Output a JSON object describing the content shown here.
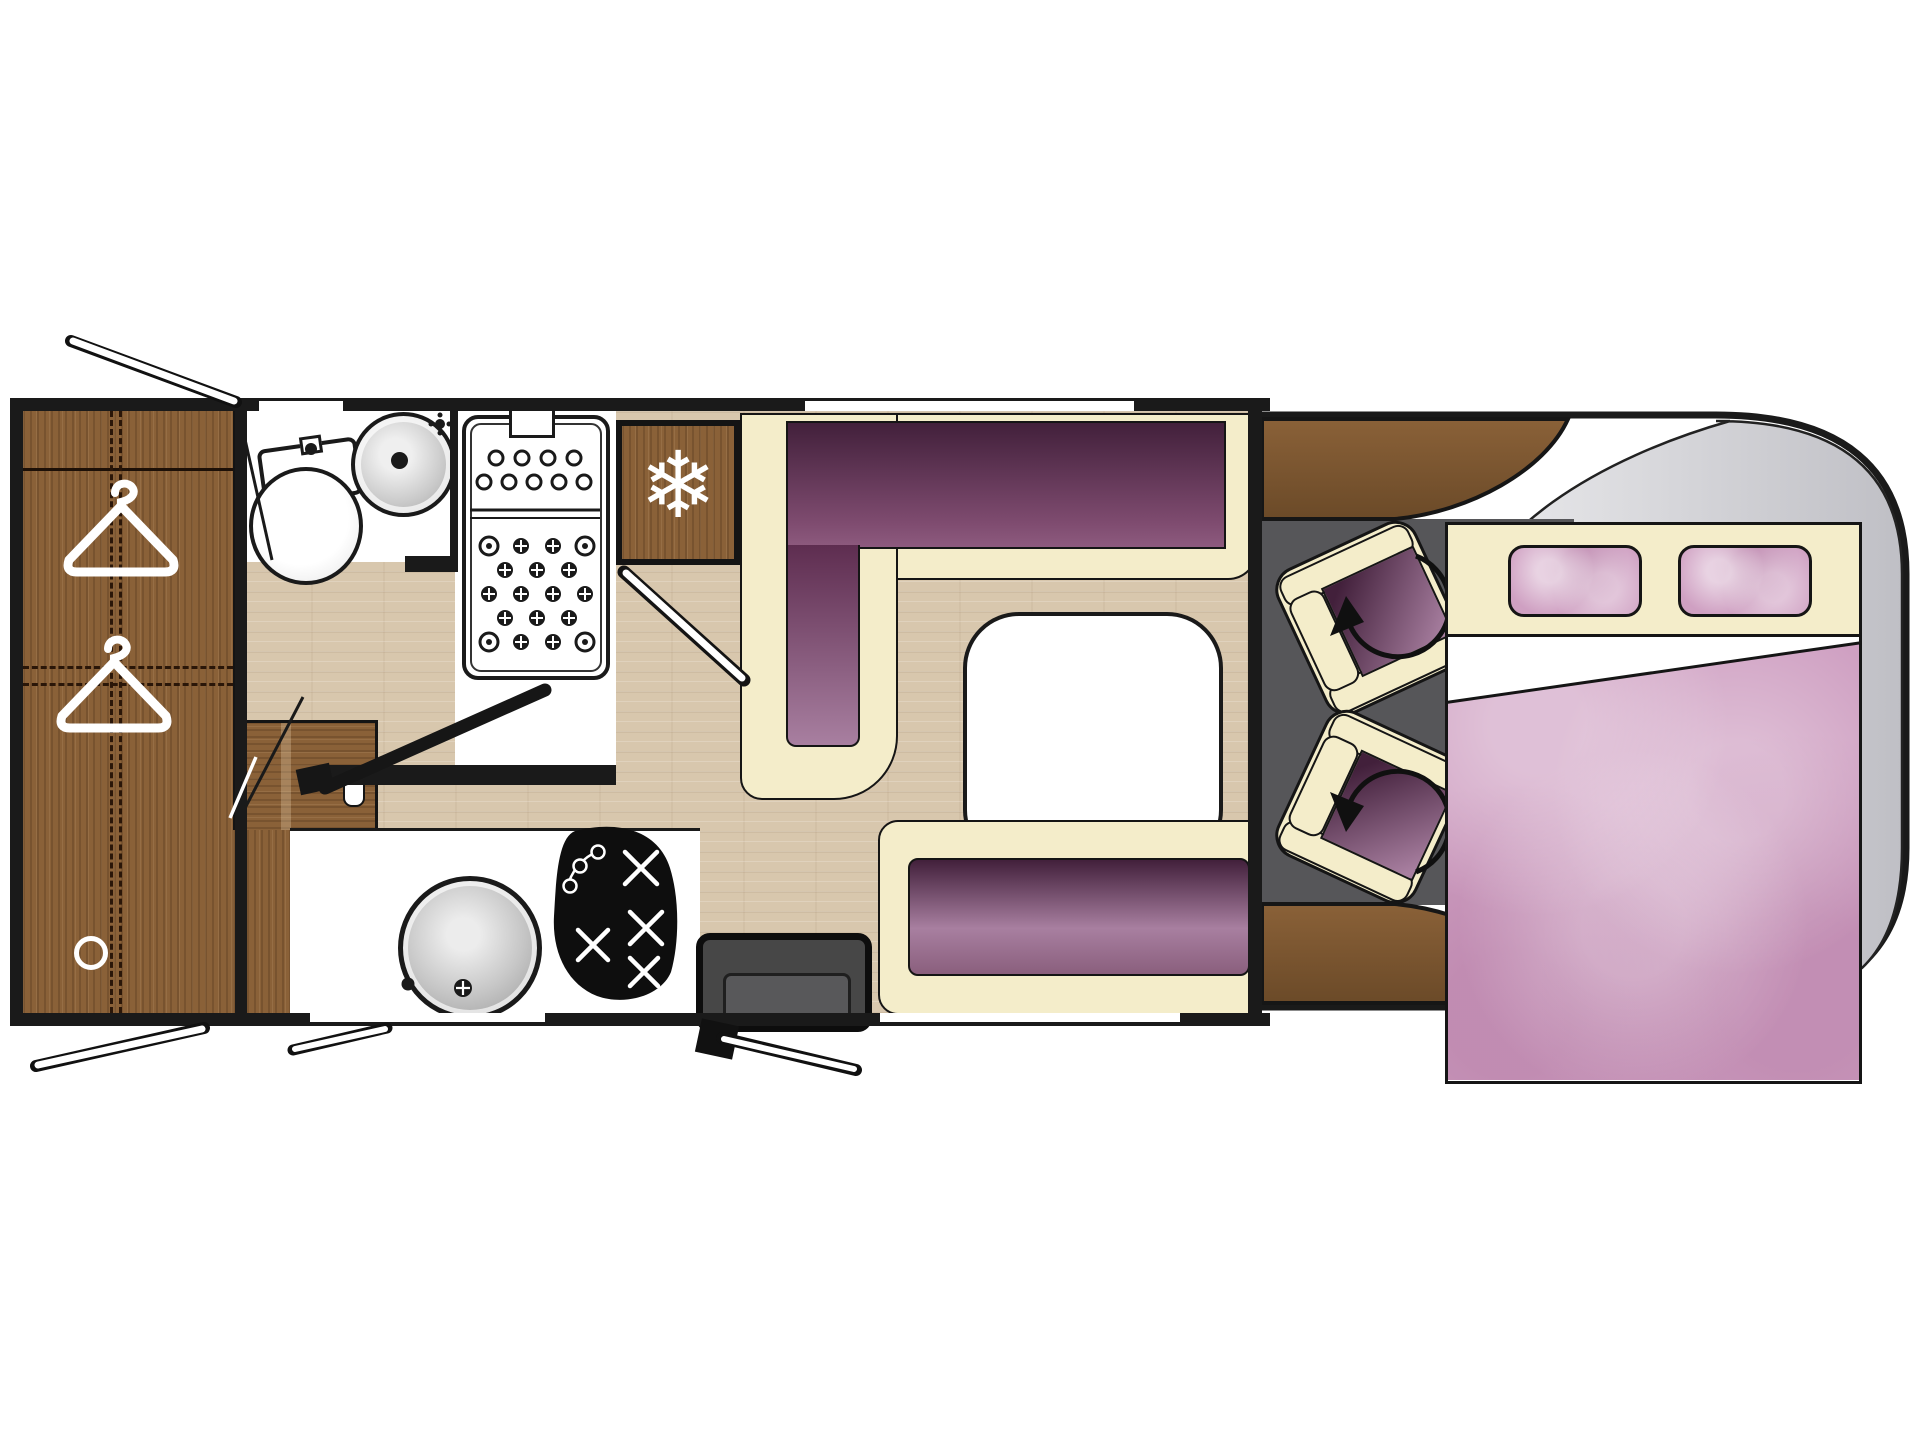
{
  "title": "motorhome-floorplan",
  "colors": {
    "wall": "#1a1a1a",
    "outline": "#151515",
    "white": "#ffffff",
    "floor": "#d8c7ad",
    "wood": "#8a6138",
    "wood_dark": "#6b4a28",
    "cream": "#f4edca",
    "purple_dark": "#42203b",
    "purple_mid": "#7e4b6f",
    "purple_soft": "#a87fa0",
    "pink": "#cfa0c2",
    "pink_light": "#e9cfe3",
    "cab_gray": "#c6c6cb",
    "cab_gray_light": "#ececee",
    "cab_floor": "#565659",
    "step_gray": "#474747"
  },
  "icons": {
    "snowflake": {
      "name": "snowflake-icon",
      "glyph": "❄"
    },
    "hanger": {
      "name": "clothes-hanger-icon",
      "shape": "svg-hanger"
    },
    "swivel": {
      "name": "swivel-rotation-arrow-icon",
      "shape": "svg-arc-arrow"
    },
    "burner": {
      "name": "hob-burner-icon",
      "shape": "svg-cross"
    }
  }
}
